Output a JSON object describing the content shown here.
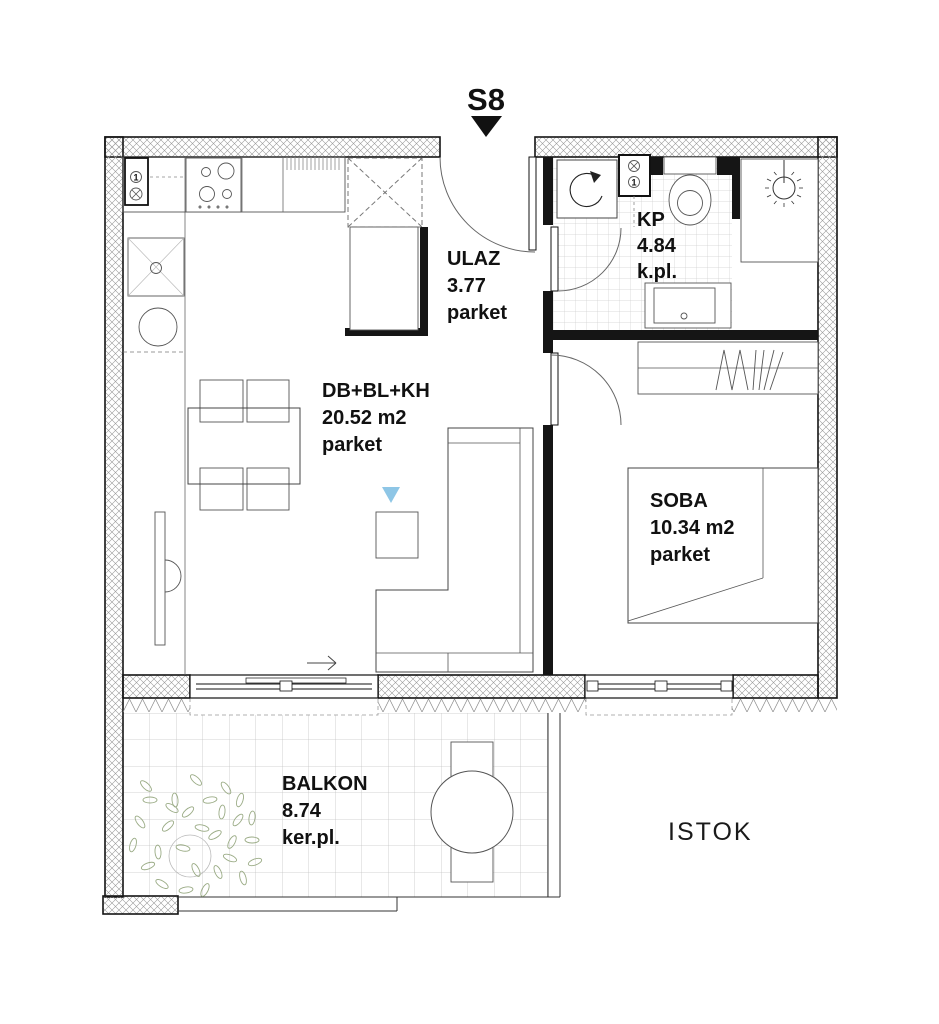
{
  "plan": {
    "unit": {
      "label": "S8"
    },
    "direction": {
      "label": "ISTOK"
    },
    "rooms": {
      "ulaz": {
        "name": "ULAZ",
        "area": "3.77",
        "floor": "parket"
      },
      "kp": {
        "name": "KP",
        "area": "4.84",
        "floor": "k.pl."
      },
      "living": {
        "name": "DB+BL+KH",
        "area": "20.52 m2",
        "floor": "parket"
      },
      "soba": {
        "name": "SOBA",
        "area": "10.34 m2",
        "floor": "parket"
      },
      "balkon": {
        "name": "BALKON",
        "area": "8.74",
        "floor": "ker.pl."
      }
    },
    "shafts": {
      "label": "1"
    },
    "colors": {
      "line": "#1a1a1a",
      "tile_grid": "#c9c9c9",
      "marker_blue": "#8ec6e6",
      "plant_green": "#9aab85"
    }
  }
}
